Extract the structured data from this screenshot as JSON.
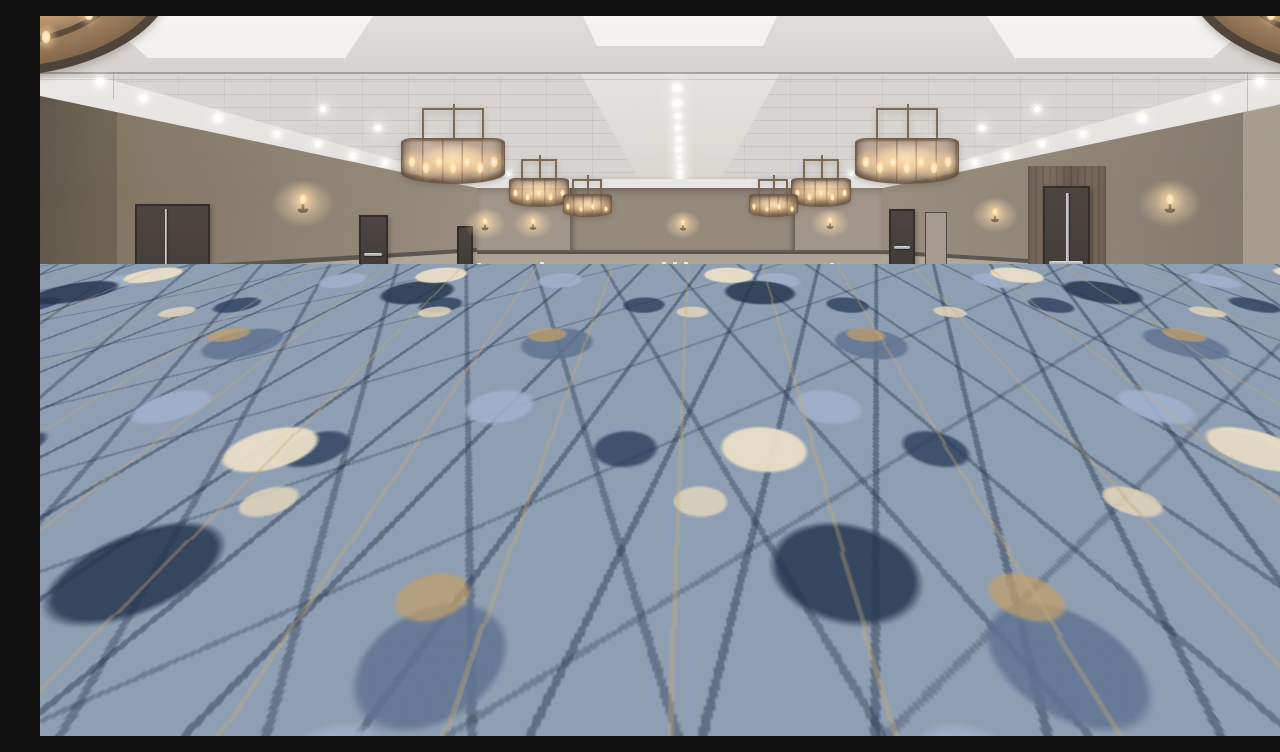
{
  "meta": {
    "title": "Empty hotel ballroom",
    "description": "Large empty hotel ballroom event space with abstract blue, cream and gold patterned carpet, taupe textured walls with wainscot and doors, bronze drum mesh chandeliers, wall sconces and rows of recessed ceiling downlights"
  },
  "scene": {
    "room_type": "ballroom",
    "palette": {
      "ceiling_base": "#d9d6d3",
      "ceiling_cove": "#e9e7e4",
      "ceiling_tile": "#d6d3d0",
      "wall_upper": "#887b6e",
      "wall_back": "#a2968a",
      "wall_recess": "#968a7d",
      "wainscot": "#b1a698",
      "rail": "#5b554e",
      "base_trim": "#57514a",
      "door": "#46403c",
      "wood_trim": "#6e6055",
      "metal": "#c9cacd",
      "chandelier_metal": "#7c6750",
      "chandelier_glow": "#f3ddb8",
      "carpet_base": "#8e9fb3",
      "carpet_navy": "#2b3d59",
      "carpet_cream": "#e7dcc6",
      "carpet_gold": "#c4a26e"
    },
    "ceiling": {
      "downlights_center": [
        [
          637,
          72,
          4
        ],
        [
          637,
          87,
          3.6
        ],
        [
          638,
          100,
          3.3
        ],
        [
          638,
          112,
          3.0
        ],
        [
          639,
          123,
          2.8
        ],
        [
          639,
          133,
          2.6
        ],
        [
          639,
          142,
          2.4
        ],
        [
          640,
          150,
          2.2
        ],
        [
          640,
          157,
          2.0
        ],
        [
          640,
          163,
          1.8
        ]
      ],
      "downlights_left": [
        [
          60,
          66,
          4.2
        ],
        [
          103,
          82,
          4.0
        ],
        [
          178,
          102,
          3.6
        ],
        [
          237,
          118,
          3.3
        ],
        [
          278,
          128,
          3.0
        ],
        [
          313,
          140,
          2.8
        ],
        [
          345,
          147,
          2.6
        ],
        [
          373,
          153,
          2.4
        ],
        [
          398,
          158,
          2.2
        ],
        [
          421,
          163,
          2.0
        ],
        [
          441,
          167,
          1.8
        ],
        [
          283,
          93,
          3.2
        ],
        [
          338,
          112,
          2.9
        ],
        [
          387,
          127,
          2.6
        ],
        [
          413,
          138,
          2.4
        ],
        [
          434,
          146,
          2.2
        ],
        [
          452,
          153,
          2.0
        ],
        [
          468,
          158,
          1.8
        ]
      ],
      "downlights_right": [
        [
          1220,
          66,
          4.2
        ],
        [
          1177,
          82,
          4.0
        ],
        [
          1102,
          102,
          3.6
        ],
        [
          1043,
          118,
          3.3
        ],
        [
          1002,
          128,
          3.0
        ],
        [
          967,
          140,
          2.8
        ],
        [
          935,
          147,
          2.6
        ],
        [
          907,
          153,
          2.4
        ],
        [
          882,
          158,
          2.2
        ],
        [
          859,
          163,
          2.0
        ],
        [
          839,
          167,
          1.8
        ],
        [
          997,
          93,
          3.2
        ],
        [
          942,
          112,
          2.9
        ],
        [
          893,
          127,
          2.6
        ],
        [
          867,
          138,
          2.4
        ],
        [
          846,
          146,
          2.2
        ],
        [
          828,
          153,
          2.0
        ],
        [
          812,
          158,
          1.8
        ]
      ],
      "coffers": [
        {
          "points": "60px 0px,333px 0px,305px 42px,108px 42px",
          "x": 0,
          "y": 0,
          "w": 400,
          "h": 50
        },
        {
          "points": "543px 0px,737px 0px,723px 30px,557px 30px",
          "x": 0,
          "y": 0,
          "w": 800,
          "h": 40
        },
        {
          "points": "947px 0px,1220px 0px,1172px 42px,975px 42px",
          "x": 0,
          "y": 0,
          "w": 1280,
          "h": 50
        }
      ]
    },
    "chandeliers": [
      {
        "type": "corner",
        "cx": -50,
        "cy": -44,
        "rx": 185,
        "ry": 105,
        "flames": [
          [
            0.78,
            0.72
          ],
          [
            0.66,
            0.84
          ]
        ]
      },
      {
        "type": "corner",
        "cx": 1330,
        "cy": -44,
        "rx": 185,
        "ry": 105,
        "flames": [
          [
            0.22,
            0.72
          ],
          [
            0.34,
            0.84
          ]
        ]
      },
      {
        "type": "drum",
        "cx": 413,
        "top": 92,
        "w": 104,
        "drumH": 46,
        "frameW": 62,
        "frameH": 30,
        "flames": 7
      },
      {
        "type": "drum",
        "cx": 867,
        "top": 92,
        "w": 104,
        "drumH": 46,
        "frameW": 62,
        "frameH": 30,
        "flames": 7
      },
      {
        "type": "drum",
        "cx": 499,
        "top": 143,
        "w": 60,
        "drumH": 29,
        "frameW": 36,
        "frameH": 19,
        "flames": 5
      },
      {
        "type": "drum",
        "cx": 781,
        "top": 143,
        "w": 60,
        "drumH": 29,
        "frameW": 36,
        "frameH": 19,
        "flames": 5
      },
      {
        "type": "drum",
        "cx": 547,
        "top": 163,
        "w": 49,
        "drumH": 23,
        "frameW": 30,
        "frameH": 15,
        "flames": 4
      },
      {
        "type": "drum",
        "cx": 733,
        "top": 163,
        "w": 49,
        "drumH": 23,
        "frameW": 30,
        "frameH": 15,
        "flames": 4
      }
    ],
    "sconces": [
      {
        "x": 263,
        "y": 186,
        "s": 1.35
      },
      {
        "x": 445,
        "y": 207,
        "s": 0.9
      },
      {
        "x": 493,
        "y": 207,
        "s": 0.85
      },
      {
        "x": 643,
        "y": 208,
        "s": 0.8
      },
      {
        "x": 790,
        "y": 206,
        "s": 0.85
      },
      {
        "x": 955,
        "y": 198,
        "s": 1.0
      },
      {
        "x": 1130,
        "y": 186,
        "s": 1.35
      }
    ],
    "doors": [
      {
        "kind": "panic-left",
        "x": 95,
        "y": 188,
        "w": 75,
        "h": 114
      },
      {
        "kind": "plain-bar",
        "x": 319,
        "y": 199,
        "w": 29,
        "h": 69
      },
      {
        "kind": "plain",
        "x": 417,
        "y": 210,
        "w": 16,
        "h": 48
      },
      {
        "kind": "plain-bar",
        "x": 849,
        "y": 193,
        "w": 26,
        "h": 68
      },
      {
        "kind": "panel",
        "x": 885,
        "y": 196,
        "w": 22,
        "h": 64
      },
      {
        "kind": "wood-surround",
        "x": 988,
        "y": 150,
        "w": 78,
        "h": 143
      },
      {
        "kind": "panic-right",
        "x": 1003,
        "y": 170,
        "w": 47,
        "h": 121
      }
    ],
    "outlets": [
      [
        242,
        272
      ],
      [
        254,
        272
      ],
      [
        437,
        247
      ],
      [
        500,
        246
      ],
      [
        622,
        246
      ],
      [
        633,
        246
      ],
      [
        644,
        246
      ],
      [
        790,
        247
      ],
      [
        985,
        267
      ],
      [
        1015,
        270
      ],
      [
        1083,
        280
      ],
      [
        1098,
        282
      ]
    ]
  }
}
